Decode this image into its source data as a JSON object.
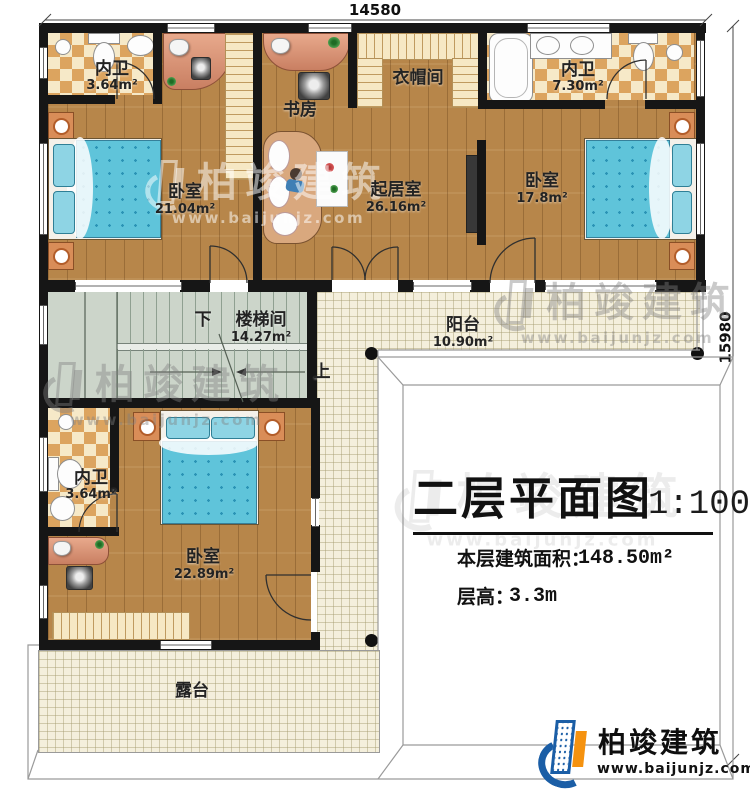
{
  "dimensions": {
    "top_width": "14580",
    "right_height": "15980"
  },
  "rooms": {
    "bath_top_left": {
      "name": "内卫",
      "area": "3.64m²"
    },
    "bedroom_top_left": {
      "name": "卧室",
      "area": "21.04m²"
    },
    "study": {
      "name": "书房"
    },
    "cloakroom": {
      "name": "衣帽间"
    },
    "living_room": {
      "name": "起居室",
      "area": "26.16m²"
    },
    "bath_top_right": {
      "name": "内卫",
      "area": "7.30m²"
    },
    "bedroom_top_right": {
      "name": "卧室",
      "area": "17.8m²"
    },
    "stairwell": {
      "name": "楼梯间",
      "area": "14.27m²",
      "down_label": "下",
      "up_label": "上"
    },
    "balcony": {
      "name": "阳台",
      "area": "10.90m²"
    },
    "bath_bottom_left": {
      "name": "内卫",
      "area": "3.64m²"
    },
    "bedroom_bottom": {
      "name": "卧室",
      "area": "22.89m²"
    },
    "terrace": {
      "name": "露台"
    }
  },
  "title_block": {
    "title": "二层平面图",
    "scale": "1:100",
    "area_label": "本层建筑面积：",
    "area_value": "148.50m²",
    "height_label": "层高：",
    "height_value": "3.3m"
  },
  "branding": {
    "company": "柏竣建筑",
    "website": "www.baijunjz.com"
  },
  "watermark": {
    "company": "柏竣建筑",
    "website": "www.baijunjz.com"
  },
  "colors": {
    "wall": "#161616",
    "wood_floor": "#b7864a",
    "tile": "#f4efdc",
    "checker_tan": "#dca45f",
    "checker_cream": "#f6e9c8",
    "bed_teal": "#5fc4da",
    "stair_floor": "#ccd5ca",
    "logo_blue": "#1b5ea6",
    "logo_orange": "#f5920f"
  }
}
